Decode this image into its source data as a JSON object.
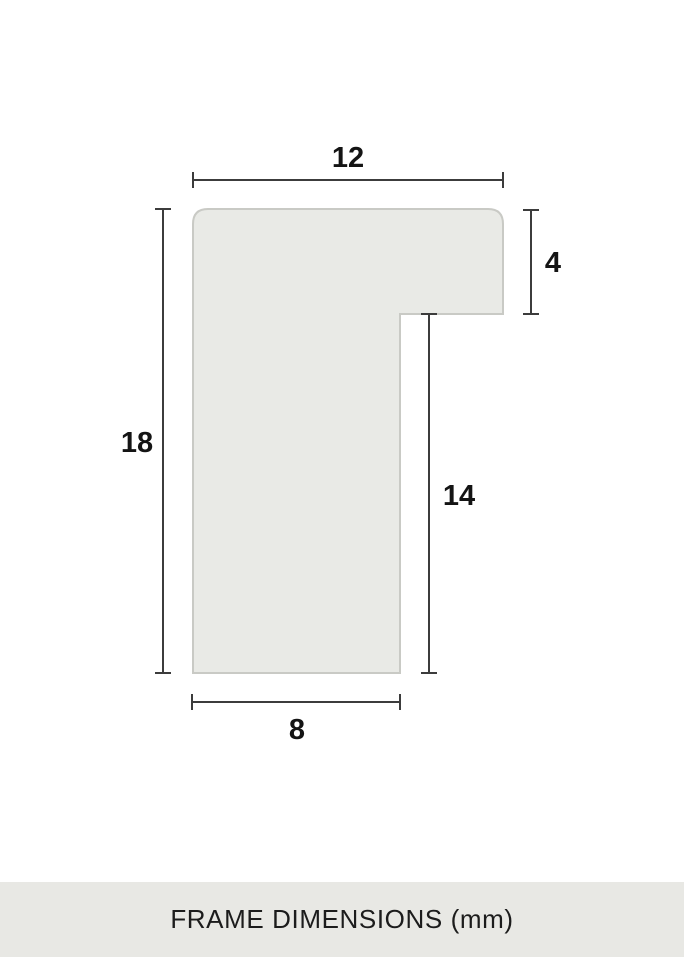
{
  "diagram": {
    "description": "frame-profile-cross-section",
    "unit": "mm",
    "dimensions": {
      "top_width": "12",
      "left_height": "18",
      "right_height": "4",
      "inner_height": "14",
      "bottom_width": "8"
    }
  },
  "footer": {
    "title": "FRAME DIMENSIONS (mm)"
  },
  "colors": {
    "background": "#ffffff",
    "shape_fill": "#e9eae6",
    "shape_border": "#c9cac5",
    "dimension_line": "#3c3c3c",
    "label_text": "#141414",
    "footer_bg": "#e8e8e4",
    "footer_text": "#1c1c1c"
  }
}
